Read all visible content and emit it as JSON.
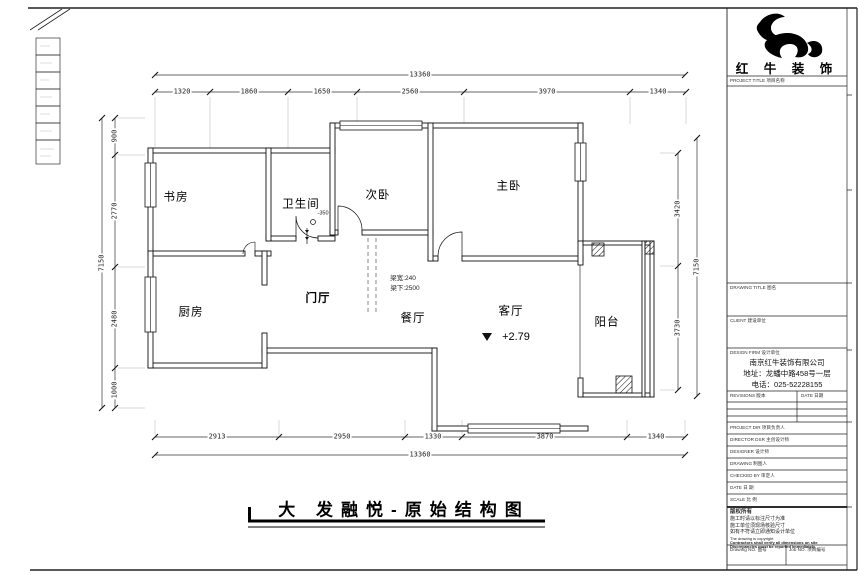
{
  "sheet": {
    "main_title": "大 发融悦-原始结构图",
    "logo_text": "红 牛 装 饰"
  },
  "rooms": {
    "study": "书房",
    "bathroom": "卫生间",
    "bedroom2": "次卧",
    "master": "主卧",
    "kitchen": "厨房",
    "foyer": "门厅",
    "dining": "餐厅",
    "living": "客厅",
    "balcony": "阳台"
  },
  "annotations": {
    "beam_width": "梁宽:240",
    "beam_under": "梁下:2500",
    "living_level": "+2.79",
    "bath_level": "-350"
  },
  "dimensions": {
    "top_total": "13360",
    "top_segments": [
      "1320",
      "1860",
      "1650",
      "2560",
      "3970",
      "1340"
    ],
    "bottom_segments": [
      "2913",
      "2950",
      "1330",
      "3870",
      "1340"
    ],
    "bottom_total": "13360",
    "left_total": "7150",
    "left_segments": [
      "900",
      "2770",
      "2480",
      "1000"
    ],
    "right_segments": [
      "3420",
      "3730"
    ],
    "right_total": "7150"
  },
  "titleblock": {
    "project_title_label": "PROJECT TITLE 项目名称",
    "drawing_title_label": "DRAWING TITLE 图名",
    "client_label": "CLIENT 建设单位",
    "design_firm_label": "DESIGN FIRM 设计单位",
    "company_name": "南京红牛装饰有限公司",
    "company_address": "地址：龙蟠中路458号一层",
    "company_phone": "电话：025-52228155",
    "revisions_label": "REVISIONS 版本",
    "date_col_label": "DATE 日期",
    "rows": [
      {
        "label": "PROJECT DIR  项目负责人"
      },
      {
        "label": "DIRECTOR DSR  主创设计师"
      },
      {
        "label": "DESIGNER  设计师"
      },
      {
        "label": "DRAWING  制图人"
      },
      {
        "label": "CHECKED BY  审定人"
      },
      {
        "label": "DATE  日  期"
      },
      {
        "label": "SCALE  比  例"
      }
    ],
    "notes": [
      "版权所有",
      "施工时请以标注尺寸为准",
      "施工单位须现场核验尺寸",
      "如有不符请立即通知设计单位",
      "The drawing is copyright",
      "Contractors shall verify all dimensions on site",
      "Discrepancies must be reported immediately"
    ],
    "drawing_no_label": "Drawing NO. 图号",
    "job_no_label": "Job NO. 项目编号"
  }
}
